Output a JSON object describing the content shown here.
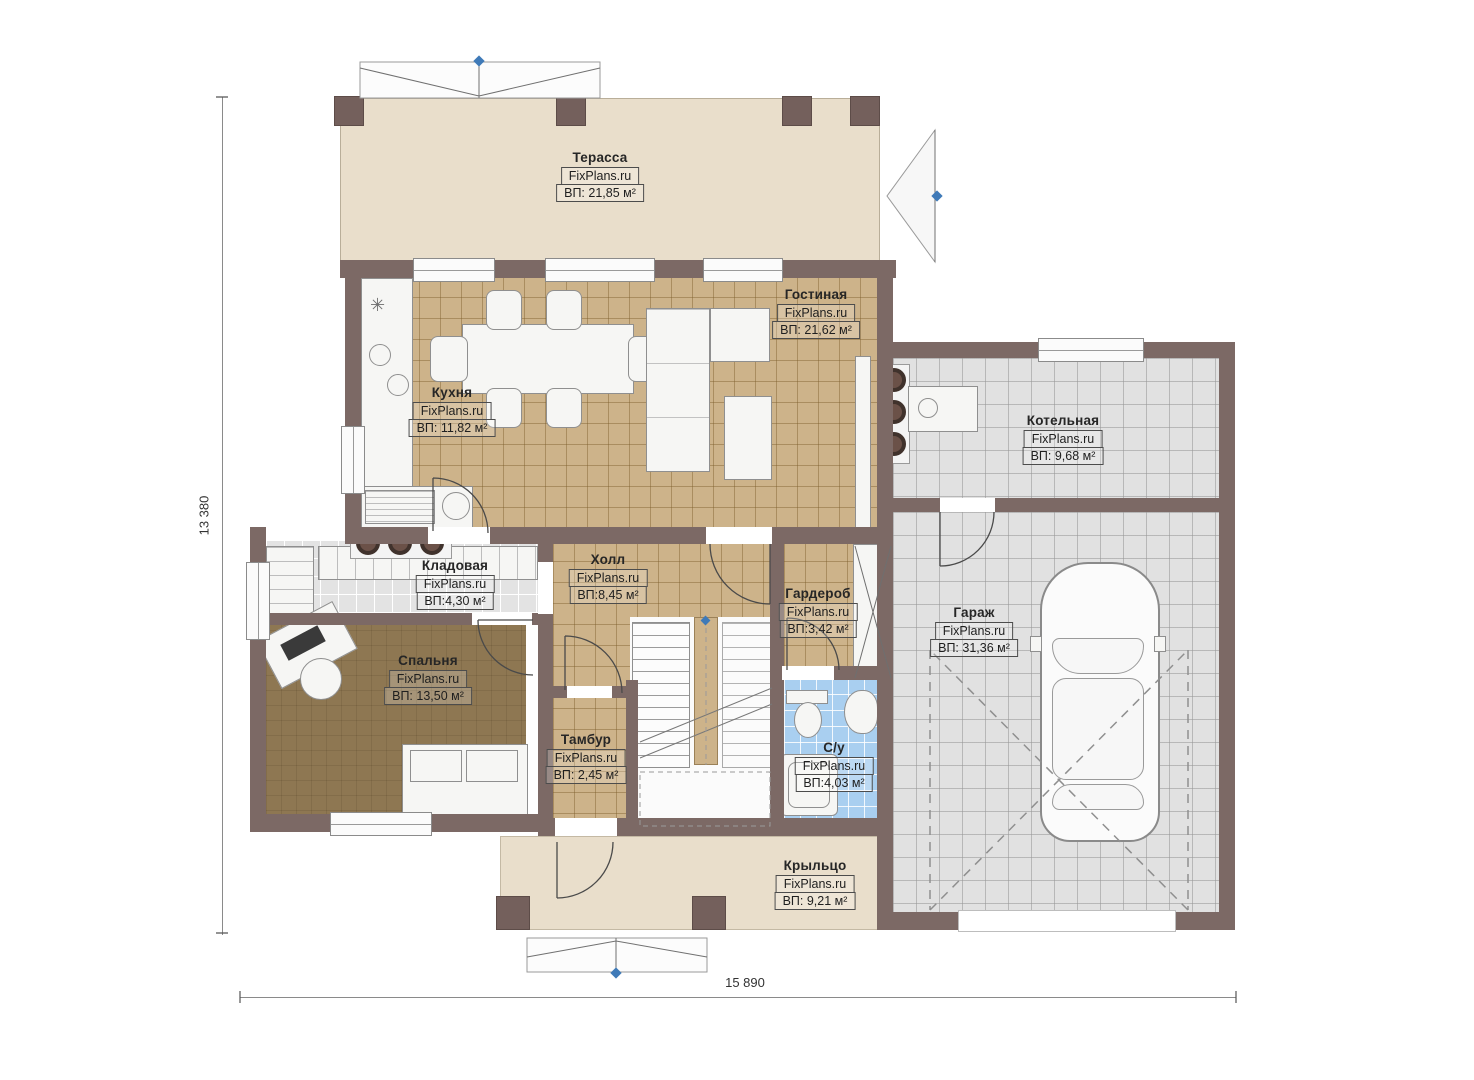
{
  "brand": "FixPlans.ru",
  "rooms": [
    {
      "name": "Терасса",
      "site": "FixPlans.ru",
      "area": "ВП: 21,85 м²"
    },
    {
      "name": "Гостиная",
      "site": "FixPlans.ru",
      "area": "ВП: 21,62 м²"
    },
    {
      "name": "Кухня",
      "site": "FixPlans.ru",
      "area": "ВП: 11,82 м²"
    },
    {
      "name": "Котельная",
      "site": "FixPlans.ru",
      "area": "ВП: 9,68 м²"
    },
    {
      "name": "Кладовая",
      "site": "FixPlans.ru",
      "area": "ВП:4,30 м²"
    },
    {
      "name": "Холл",
      "site": "FixPlans.ru",
      "area": "ВП:8,45 м²"
    },
    {
      "name": "Гардероб",
      "site": "FixPlans.ru",
      "area": "ВП:3,42 м²"
    },
    {
      "name": "Гараж",
      "site": "FixPlans.ru",
      "area": "ВП: 31,36 м²"
    },
    {
      "name": "Спальня",
      "site": "FixPlans.ru",
      "area": "ВП: 13,50 м²"
    },
    {
      "name": "Тамбур",
      "site": "FixPlans.ru",
      "area": "ВП: 2,45 м²"
    },
    {
      "name": "С/у",
      "site": "FixPlans.ru",
      "area": "ВП:4,03 м²"
    },
    {
      "name": "Крыльцо",
      "site": "FixPlans.ru",
      "area": "ВП: 9,21 м²"
    }
  ],
  "dimensions": {
    "height_label": "13 380",
    "width_label": "15 890"
  },
  "icons": {
    "kitchen-asterisk": "✳"
  },
  "colors": {
    "wall": "#7c6965",
    "terrace": "#e9decb",
    "tile_tan": "#cdb38a",
    "tile_gray": "#e1e1e1",
    "tile_blue": "#a9cff0",
    "bedroom_floor": "#8e7752",
    "marker_blue": "#3f7ab8"
  }
}
